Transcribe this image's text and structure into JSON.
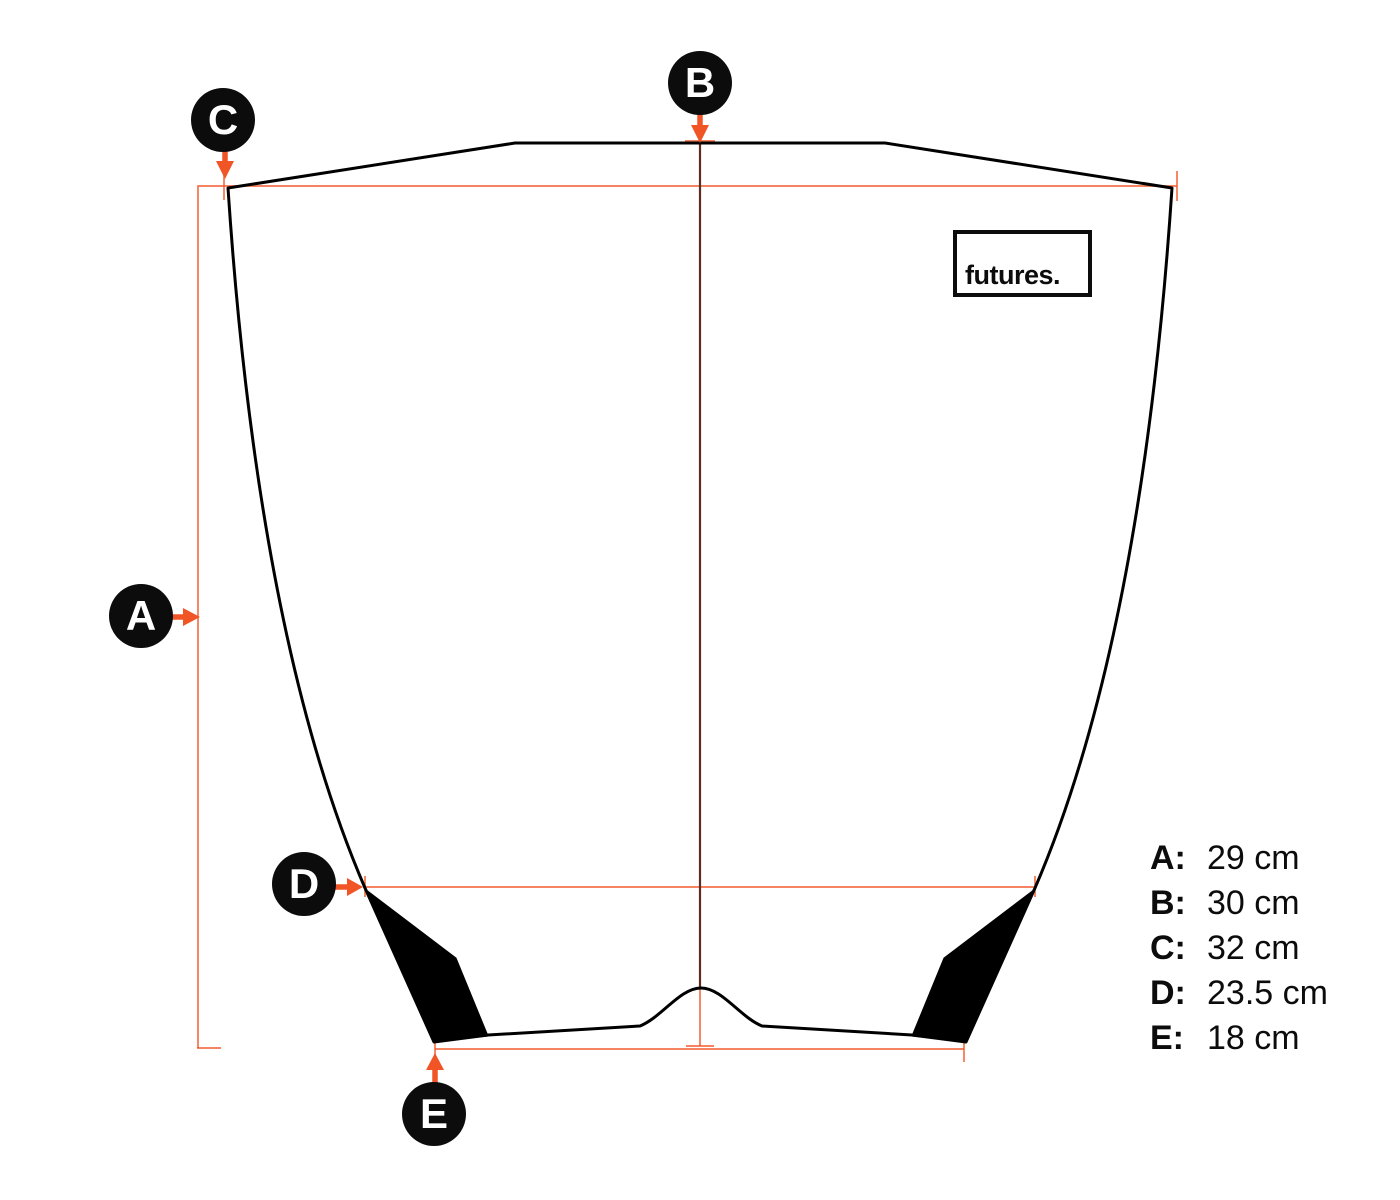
{
  "brand": {
    "logo_text": "futures."
  },
  "markers": {
    "a": {
      "label": "A"
    },
    "b": {
      "label": "B"
    },
    "c": {
      "label": "C"
    },
    "d": {
      "label": "D"
    },
    "e": {
      "label": "E"
    }
  },
  "legend": {
    "items": [
      {
        "key": "A:",
        "value": "29 cm"
      },
      {
        "key": "B:",
        "value": "30 cm"
      },
      {
        "key": "C:",
        "value": "32 cm"
      },
      {
        "key": "D:",
        "value": "23.5 cm"
      },
      {
        "key": "E:",
        "value": "18 cm"
      }
    ]
  },
  "colors": {
    "dimension_line": "#F15425",
    "center_line": "#5F2C20",
    "outline": "#000000",
    "badge_bg": "#0C0C0C",
    "badge_text": "#FFFFFF"
  }
}
